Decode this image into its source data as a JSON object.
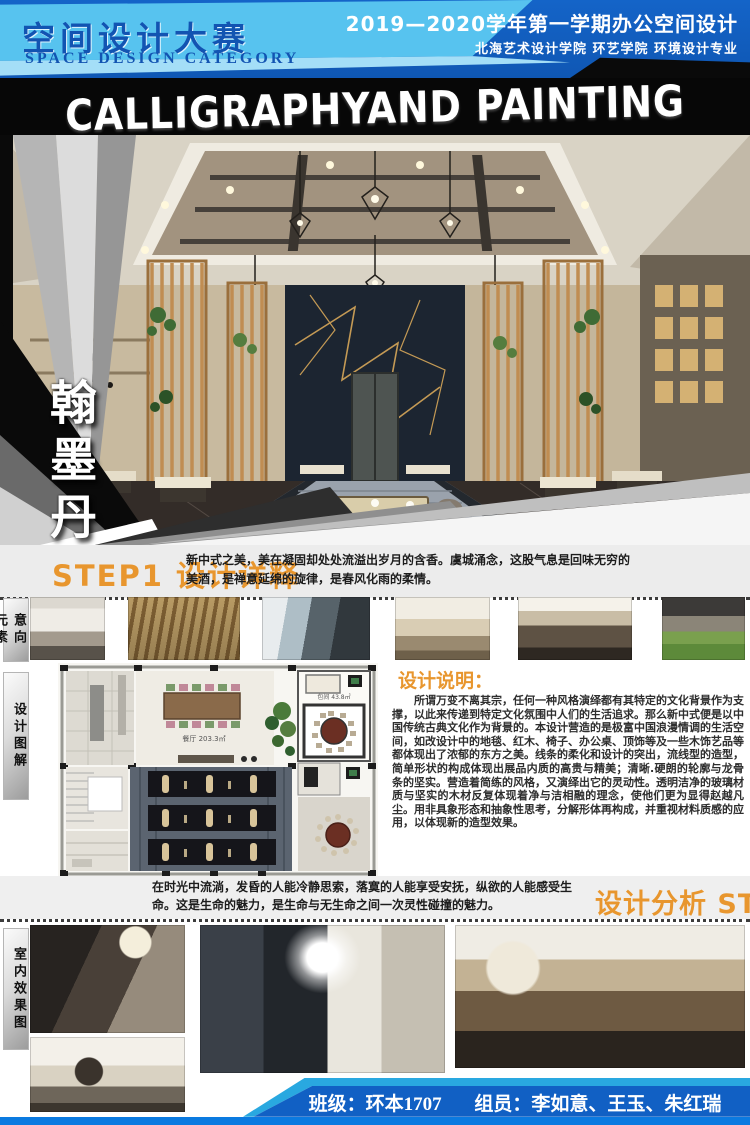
{
  "header": {
    "title": "空间设计大赛",
    "subtitle": "SPACE DESIGN CATEGORY",
    "term_line": "2019—2020学年第一学期办公空间设计",
    "school_line": "北海艺术设计学院 环艺学院 环境设计专业"
  },
  "banner": {
    "title": "CALLIGRAPHYAND PAINTING"
  },
  "hero": {
    "vertical_title": "翰墨丹青"
  },
  "step1": {
    "heading": "STEP1 设计详释",
    "intro": "新中式之美，美在凝固却处处流溢出岁月的含香。虞城涌念，这股气息是回味无穷的美酒，是禅意延绵的旋律，是春风化雨的柔情。"
  },
  "labels": {
    "intent_elements": "意向元素",
    "design_diagram": "设计图解",
    "interior_renderings": "室内效果图"
  },
  "floor_plan": {
    "dining_label": "餐厅 203.3㎡",
    "room_label": "包间 43.8㎡"
  },
  "design_note": {
    "heading": "设计说明：",
    "body": "所谓万变不离其宗，任何一种风格演绎都有其特定的文化背景作为支撑，以此来传递到特定文化氛围中人们的生活追求。那么新中式便是以中国传统古典文化作为背景的。本设计营造的是极富中国浪漫情调的生活空间，如改设计中的地毯、红木、椅子、办公桌、顶饰等及一些木饰艺品等都体现出了浓郁的东方之美。线条的柔化和设计的突出，流线型的造型，简单形状的构成体现出展品内质的高贵与精美；清晰.硬朗的轮廓与龙骨条的坚实。营造着简练的风格，又演绎出它的灵动性。透明洁净的玻璃材质与坚实的木材反复体现着净与洁相融的理念，使他们更为显得赵越凡尘。用非具象形态和抽象性思考，分解形体再构成，并重视材料质感的应用，以体现新的造型效果。"
  },
  "step2": {
    "heading": "设计分析 STEP2",
    "intro": "在时光中流淌，发昏的人能冷静思索，落寞的人能享受安抚，纵欲的人能感受生命。这是生命的魅力，是生命与无生命之间一次灵性碰撞的魅力。"
  },
  "footer": {
    "class_label": "班级：环本1707",
    "members_label": "组员：李如意、王玉、朱红瑞"
  },
  "colors": {
    "accent_orange": "#e8962e",
    "header_dark_blue": "#1464c8",
    "header_light_blue": "#57c3ef",
    "footer_blue": "#1160c4",
    "footer_strip_blue": "#0b7ae0"
  }
}
